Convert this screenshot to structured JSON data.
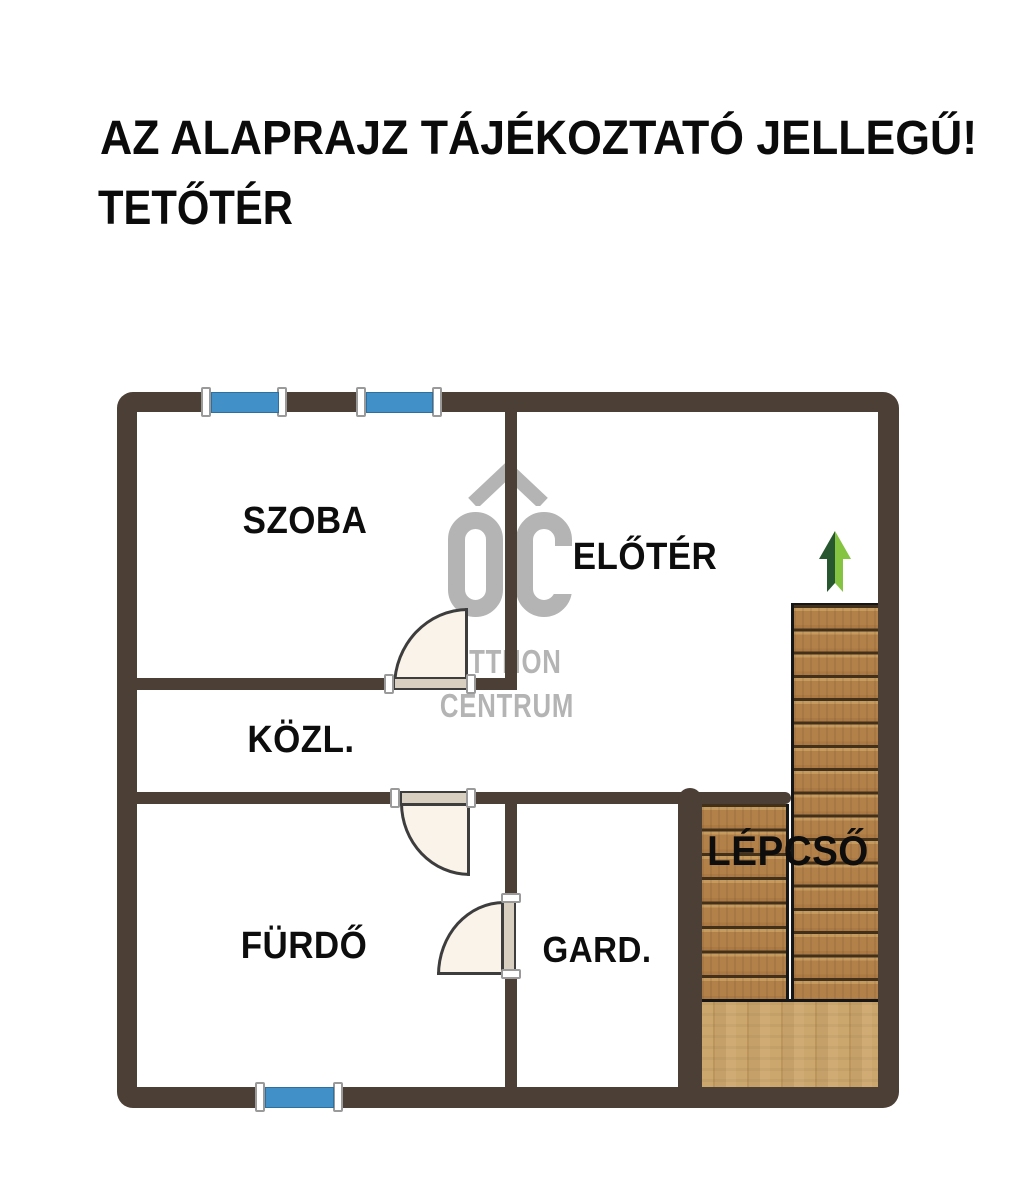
{
  "header": {
    "disclaimer": "AZ ALAPRAJZ TÁJÉKOZTATÓ JELLEGŰ!",
    "floor": "TETŐTÉR"
  },
  "rooms": {
    "szoba": "SZOBA",
    "eloter": "ELŐTÉR",
    "kozl": "KÖZL.",
    "furdo": "FÜRDŐ",
    "gard": "GARD.",
    "lepcso": "LÉPCSŐ"
  },
  "watermark": {
    "initials": "OC",
    "line1": "OTTHON",
    "line2": "CENTRUM"
  },
  "colors": {
    "wall": "#4c3f36",
    "window": "#4190c7",
    "doorfill": "#faf3ea",
    "doorleaf": "#d9cfc0",
    "stairwood": "#b28049",
    "stairdark": "#42301b",
    "landing": "#cba76e",
    "wm": "#b4b4b4",
    "arrowdark": "#27572e",
    "arrowlight": "#84c441"
  }
}
